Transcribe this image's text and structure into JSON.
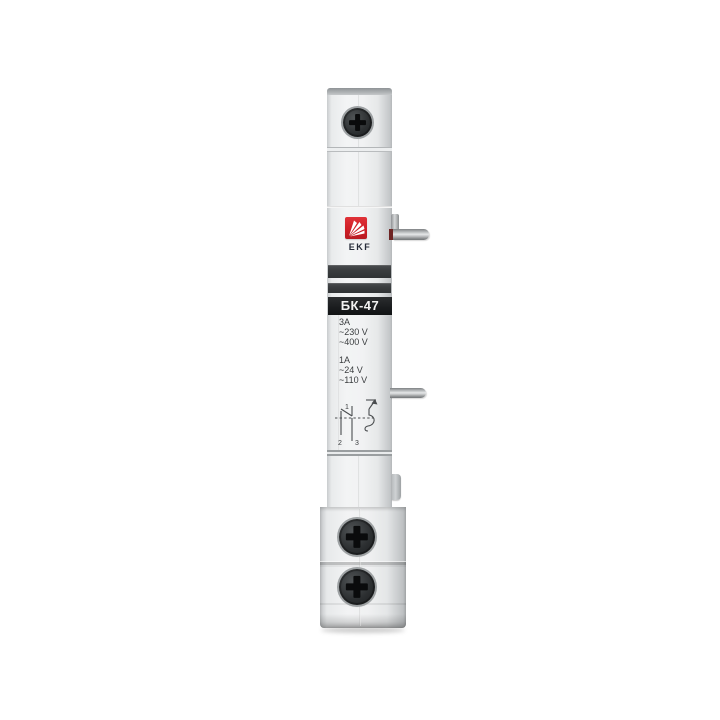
{
  "device": {
    "brand": "EKF",
    "model": "БК-47",
    "ratings_primary": {
      "lines": [
        "3A",
        "~230 V",
        "~400 V"
      ]
    },
    "ratings_secondary": {
      "lines": [
        "1A",
        "~24 V",
        "~110 V"
      ]
    },
    "diagram": {
      "terminal_top": "1",
      "terminal_bottom_left": "2",
      "terminal_bottom_right": "3"
    },
    "colors": {
      "background": "#ffffff",
      "body_light": "#f2f3f4",
      "body_edge": "#c3c6c8",
      "top_cap": "#9fa3a6",
      "band_dark": "#3a3d3f",
      "model_band": "#1a1c1e",
      "model_text": "#f2f2f2",
      "logo_red": "#cf1f27",
      "brand_text": "#262b38",
      "ratings_text": "#3a3d3f",
      "screw_dark": "#1d1f21",
      "pin_metal": "#c9cbcc",
      "pin_ring_red": "#6e2424"
    }
  }
}
